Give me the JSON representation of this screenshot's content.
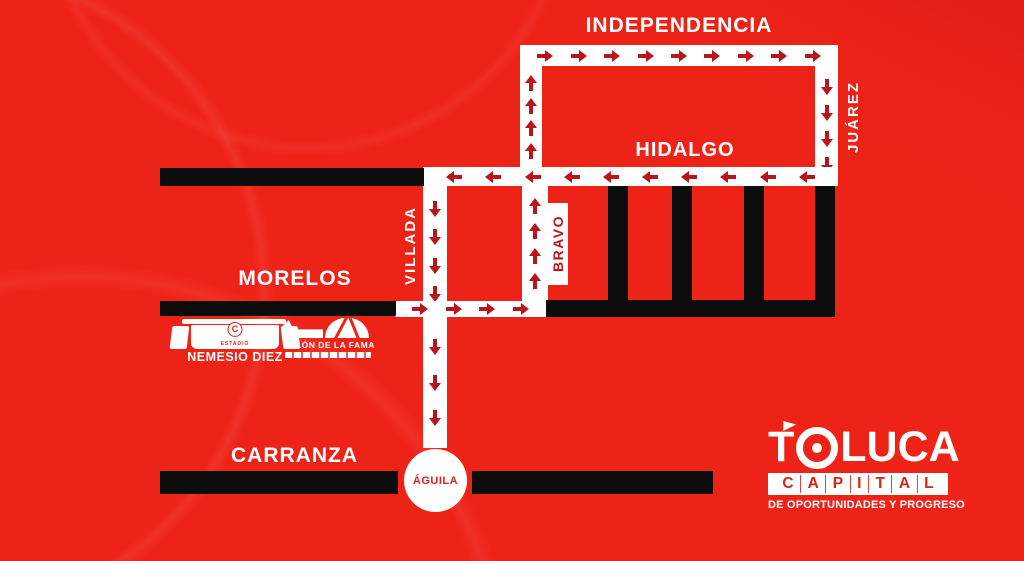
{
  "colors": {
    "background": "#ee2318",
    "road_white": "#ffffff",
    "road_black": "#0c0c0c",
    "arrow_red": "#b8161c",
    "label_white": "#ffffff",
    "brand_red": "#d8231f"
  },
  "map": {
    "streets": {
      "independencia": {
        "label": "INDEPENDENCIA",
        "arrow_dir": "right",
        "arrow_count": 9
      },
      "juarez": {
        "label": "JUÁREZ",
        "arrow_dir": "down",
        "arrow_count": 4
      },
      "hidalgo": {
        "label": "HIDALGO",
        "arrow_dir": "left",
        "arrow_count": 10
      },
      "villada": {
        "label": "VILLADA",
        "arrow_dir": "down",
        "arrow_count_upper": 4,
        "arrow_count_lower": 3
      },
      "bravo": {
        "label": "BRAVO",
        "arrow_dir": "up",
        "arrow_count_upper": 4,
        "arrow_count_lower": 4
      },
      "morelos": {
        "label": "MORELOS",
        "arrow_dir": "right",
        "arrow_count": 4
      },
      "carranza": {
        "label": "CARRANZA"
      },
      "aguila": {
        "label": "ÁGUILA"
      }
    },
    "landmarks": {
      "estadio_nemesio_diez": {
        "name": "NEMESIO DIEZ",
        "small_text": "ESTADIO",
        "crest_letter": "C"
      },
      "salon_de_la_fama": {
        "name": "SALÓN DE LA FAMA"
      }
    }
  },
  "branding": {
    "city_prefix": "T",
    "city_suffix": "LUCA",
    "word": "CAPITAL",
    "tagline": "DE OPORTUNIDADES Y PROGRESO"
  }
}
